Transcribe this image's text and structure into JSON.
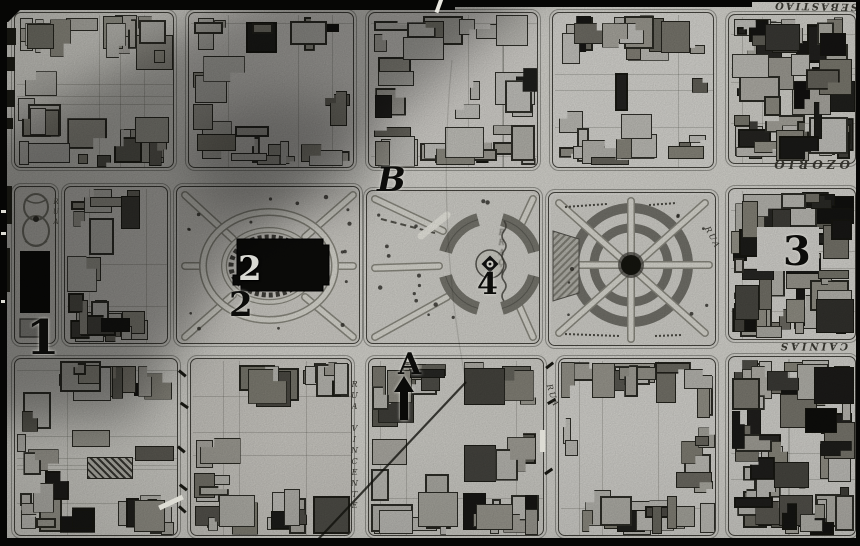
{
  "scan": {
    "description": "historical city plan scan, black and white",
    "paper_color": "#d6d5cf",
    "ink_color": "#2b2a26",
    "annotation_color": "#0c0c0a"
  },
  "map": {
    "annotations": [
      {
        "id": "1",
        "text": "1",
        "x": 26,
        "y": 314,
        "size": 48
      },
      {
        "id": "2-light",
        "text": "2",
        "x": 238,
        "y": 252,
        "size": 34,
        "light": true
      },
      {
        "id": "2-dark",
        "text": "2",
        "x": 229,
        "y": 288,
        "size": 34
      },
      {
        "id": "3",
        "text": "3",
        "x": 783,
        "y": 232,
        "size": 40
      },
      {
        "id": "4",
        "text": "4",
        "x": 477,
        "y": 270,
        "size": 30
      },
      {
        "id": "A",
        "text": "A",
        "x": 398,
        "y": 350,
        "size": 30
      },
      {
        "id": "B",
        "text": "B",
        "x": 377,
        "y": 163,
        "size": 34,
        "italic": true
      }
    ],
    "street_labels": [
      {
        "id": "ozorio",
        "text": "OZORIO",
        "x": 754,
        "y": 158,
        "w": 96,
        "rotate": 180,
        "size": 12,
        "spacing": 4,
        "bold": true,
        "italic": true
      },
      {
        "id": "sebastiao",
        "text": "SEBASTIAO",
        "x": 746,
        "y": 0,
        "w": 112,
        "rotate": 181,
        "size": 10,
        "spacing": 2,
        "bold": true,
        "italic": true
      },
      {
        "id": "cainias",
        "text": "CAINIAS",
        "x": 744,
        "y": 340,
        "w": 104,
        "rotate": 180,
        "size": 10,
        "spacing": 3,
        "bold": true,
        "italic": true
      },
      {
        "id": "rua-vincente",
        "text": "RUA VINCENTE",
        "x": 350,
        "y": 380,
        "vertical": true,
        "size": 8,
        "spacing": 2,
        "italic": true
      },
      {
        "id": "praca",
        "text": "PRAÇA",
        "x": 497,
        "y": 228,
        "vertical": true,
        "size": 8,
        "spacing": 1,
        "blur": true,
        "italic": true
      },
      {
        "id": "rua-sw",
        "text": "RUA",
        "x": 540,
        "y": 392,
        "rotate": 72,
        "size": 8,
        "spacing": 2,
        "italic": true
      },
      {
        "id": "rua-ne",
        "text": "RUA",
        "x": 700,
        "y": 234,
        "rotate": 62,
        "size": 8,
        "spacing": 2,
        "italic": true
      },
      {
        "id": "rua-garden",
        "text": "RUA",
        "x": 52,
        "y": 198,
        "vertical": true,
        "size": 7,
        "spacing": 2,
        "italic": true
      }
    ],
    "blocks": [
      {
        "id": "block-r1-c1",
        "kind": "buildings",
        "x": 14,
        "y": 12,
        "w": 160,
        "h": 156,
        "seed": 11,
        "density": 1.15,
        "dark": 0.35
      },
      {
        "id": "block-r1-c2",
        "kind": "buildings",
        "x": 188,
        "y": 12,
        "w": 166,
        "h": 156,
        "seed": 22,
        "density": 0.85,
        "dark": 0.3
      },
      {
        "id": "block-r1-c3",
        "kind": "buildings",
        "x": 368,
        "y": 12,
        "w": 170,
        "h": 156,
        "seed": 33,
        "density": 1.2,
        "dark": 0.42
      },
      {
        "id": "block-r1-c4",
        "kind": "buildings",
        "x": 552,
        "y": 12,
        "w": 162,
        "h": 156,
        "seed": 44,
        "density": 1.0,
        "dark": 0.35
      },
      {
        "id": "block-r1-c5",
        "kind": "buildings",
        "x": 728,
        "y": 14,
        "w": 128,
        "h": 150,
        "seed": 55,
        "density": 2.4,
        "dark": 0.8
      },
      {
        "id": "block-garden-strip",
        "kind": "garden",
        "x": 14,
        "y": 186,
        "w": 42,
        "h": 158,
        "seed": 66
      },
      {
        "id": "block-r2-c1",
        "kind": "buildings",
        "x": 64,
        "y": 186,
        "w": 104,
        "h": 158,
        "seed": 77,
        "density": 1.25,
        "dark": 0.45
      },
      {
        "id": "plaza-church",
        "kind": "plaza-church",
        "x": 176,
        "y": 186,
        "w": 184,
        "h": 158,
        "seed": 88
      },
      {
        "id": "plaza-fountain",
        "kind": "plaza-fountain",
        "x": 366,
        "y": 190,
        "w": 174,
        "h": 154,
        "seed": 99
      },
      {
        "id": "plaza-rings",
        "kind": "plaza-rings",
        "x": 548,
        "y": 192,
        "w": 168,
        "h": 154,
        "seed": 111
      },
      {
        "id": "block-r2-c5",
        "kind": "buildings",
        "x": 728,
        "y": 188,
        "w": 128,
        "h": 152,
        "seed": 122,
        "density": 2.2,
        "dark": 0.75,
        "clear": {
          "x": 28,
          "y": 38,
          "w": 62,
          "h": 44
        }
      },
      {
        "id": "block-r3-c1",
        "kind": "buildings",
        "x": 14,
        "y": 358,
        "w": 164,
        "h": 178,
        "seed": 133,
        "density": 1.1,
        "dark": 0.4,
        "hatch": {
          "x": 72,
          "y": 98,
          "w": 46,
          "h": 22
        }
      },
      {
        "id": "block-r3-c2",
        "kind": "buildings",
        "x": 190,
        "y": 358,
        "w": 162,
        "h": 178,
        "seed": 144,
        "density": 1.05,
        "dark": 0.4
      },
      {
        "id": "block-r3-c3",
        "kind": "buildings",
        "x": 368,
        "y": 358,
        "w": 176,
        "h": 178,
        "seed": 155,
        "density": 1.15,
        "dark": 0.45
      },
      {
        "id": "block-r3-c4",
        "kind": "buildings",
        "x": 558,
        "y": 358,
        "w": 158,
        "h": 178,
        "seed": 166,
        "density": 1.1,
        "dark": 0.4
      },
      {
        "id": "block-r3-c5",
        "kind": "buildings",
        "x": 728,
        "y": 356,
        "w": 128,
        "h": 180,
        "seed": 177,
        "density": 2.3,
        "dark": 0.8
      }
    ]
  }
}
